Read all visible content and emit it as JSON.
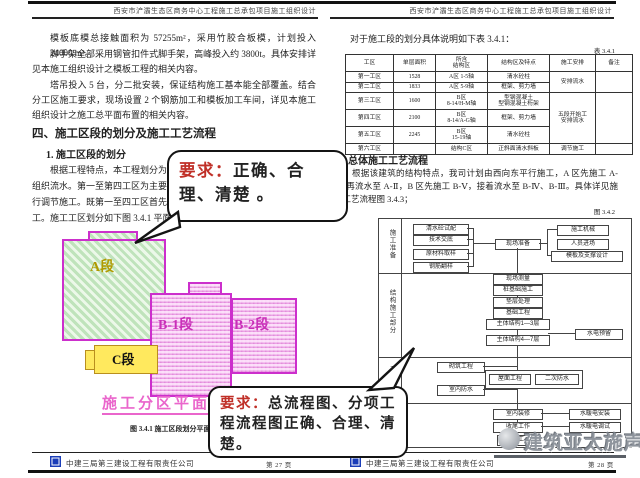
{
  "doc_header": "西安市浐灞生态区商务中心工程施工总承包项目施工组织设计",
  "page_left": {
    "para1": "模板底模总接触面积为 57255m²，采用竹胶合板模，计划投入 24000 m²。",
    "para2": "脚手架全部采用钢管扣件式脚手架，高峰投入约 3800t。具体安排详见本施工组织设计之模板工程的相关内容。",
    "para3": "塔吊投入 5 台，分二批安装，保证结构施工基本能全部覆盖。结合分工区施工要求，现场设置 2 个钢筋加工和模板加工车间，详见本施工组织设计之施工总平面布置的相关内容。",
    "heading": "四、施工区段的划分及施工工艺流程",
    "subheading": "1. 施工区段的划分",
    "para4_l1": "根据工程特点，本工程划分为五个区",
    "para4_l2": "组织流水。第一至第四工区为主要控制工",
    "para4_l3": "行调节施工。既第一至四工区首先完成后",
    "para4_l4": "工。施工工区划分如下图 3.4.1 平面示意",
    "plan": {
      "zone_a": "A段",
      "zone_b1": "B-1段",
      "zone_b2": "B-2段",
      "zone_c": "C段",
      "plan_label": "施工分区平面图",
      "caption": "图 3.4.1 施工区段划分平面示意图"
    },
    "footer": {
      "company": "中建三局第三建设工程有限责任公司",
      "page": "第 27 页"
    }
  },
  "page_right": {
    "intro": "对于施工段的划分具体说明如下表 3.4.1：",
    "table_label": "表 3.4.1",
    "table": {
      "headers": [
        "工区",
        "单层面积",
        "所含\n结构区",
        "结构区及特点",
        "施工安排",
        "备注"
      ],
      "rows": [
        [
          "第一工区",
          "1528",
          "A区 1-5轴",
          "清水砼柱"
        ],
        [
          "第二工区",
          "1833",
          "A区 5-9轴",
          "框架、剪力墙"
        ],
        [
          "第三工区",
          "1600",
          "B区\n8-14/H-M轴",
          "型钢混凝土\n型钢混凝土桁架"
        ],
        [
          "第四工区",
          "2100",
          "B区\n8-14/A-G轴",
          "框架、剪力墙"
        ],
        [
          "第五工区",
          "2245",
          "B区\n15-19轴",
          "清水砼柱"
        ],
        [
          "第六工区",
          "",
          "结构C区",
          "正斜面清水斜板"
        ]
      ],
      "arrange_1_2": "安排流水",
      "arrange_3_5": "五段开始工\n安排流水",
      "arrange_6": "调节施工",
      "note_empty": ""
    },
    "heading": "2. 总体施工工艺流程",
    "para": "根据该建筑的结构特点，我司计划由西向东平行施工，A 区先施工 A-Ⅰ，再流水至 A-Ⅱ，B 区先施工 B-Ⅴ，接着流水至 B-Ⅳ、B-Ⅲ。具体详见施工工艺流程图 3.4.3；",
    "fig_label": "图 3.4.2",
    "flowchart": {
      "sections": [
        "施工准备",
        "结构施工部分",
        "二次结构",
        "装饰装修"
      ],
      "prep_left": [
        "清水砼试配",
        "技术交底",
        "原材料取样",
        "钢筋翻样"
      ],
      "prep_center": "现场准备",
      "prep_right": [
        "施工机械",
        "人员进场",
        "模板及支撑设计"
      ],
      "struct_chain": [
        "现场测量",
        "桩基础施工",
        "垫层处理",
        "基础工程",
        "主体结构1—3层",
        "主体结构4—7层"
      ],
      "struct_side": "水电预留",
      "second_left": [
        "砌筑工程",
        "室内防水"
      ],
      "second_pair": [
        "屋面工程",
        "二次防水"
      ],
      "finish_chain": [
        "室内装修",
        "收尾工作",
        "竣工"
      ],
      "finish_right": [
        "水暖电安装",
        "水暖电调试"
      ]
    },
    "footer": {
      "company": "中建三局第三建设工程有限责任公司",
      "page": "第 28 页"
    }
  },
  "callout_1": {
    "prefix": "要求：",
    "text": "正确、合理、清楚 。"
  },
  "callout_2": {
    "prefix": "要求：",
    "text": "总流程图、分项工程流程图正确、合理、清楚。"
  },
  "watermark": {
    "text": "建筑亚太施声"
  },
  "colors": {
    "callout_red": "#c03028",
    "zone_border_magenta": "#cc2fcc",
    "zone_a_green": "#bfe3bb",
    "zone_b_pink": "#f8d6f4",
    "zone_c_yellow": "#ffe95e",
    "plan_label_pink": "#ea66cc",
    "logo_blue": "#1a3db8",
    "watermark_gray": "#8f959d"
  }
}
